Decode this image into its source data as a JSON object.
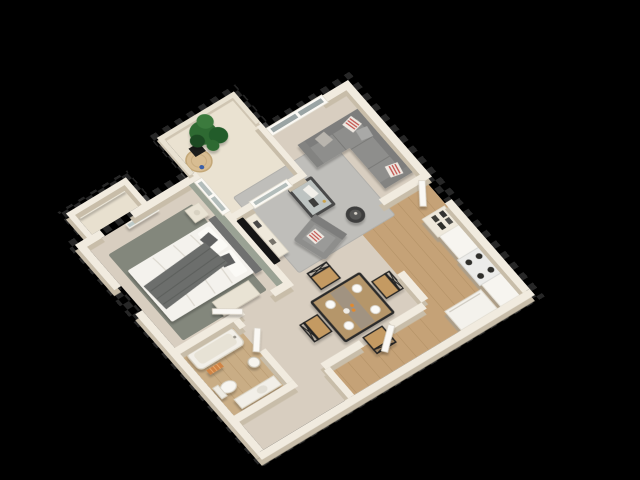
{
  "meta": {
    "description": "3D isometric dollhouse render of a one-bedroom apartment floor plan, rotated roughly 33 degrees, floating on a solid black background",
    "render_style": "photoreal architectural 3D floor plan, top-down oblique view",
    "visible_text": "none"
  },
  "palette": {
    "bg": "#000000",
    "wallTop": "#f1ebdf",
    "wallSide": "#c8bda9",
    "wallLow": "#e9e2d2",
    "carpet": "#d8cec0",
    "wood": "#c5a277",
    "bathFloor": "#c9ad85",
    "rugLiving": "#bfbeba",
    "rugBedroom": "#83877c",
    "sofa": "#8e8e8c",
    "sofaDark": "#7d7d7b",
    "accentWall": "#9aa294",
    "blanket": "#6c6e6c",
    "tableWood": "#b5966b",
    "chairWood": "#c49a62",
    "frameBlack": "#232321",
    "plantGreen": "#2e6b33",
    "towelOrange": "#d08445",
    "glass": "#bcc8c6",
    "white": "#f4f2ec"
  },
  "rooms": [
    {
      "id": "living-room",
      "name": "Living Room",
      "floor": "beige carpet",
      "furniture": [
        "gray L-shaped sectional sofa",
        "red-and-white striped throw pillows",
        "glass coffee table with books",
        "gray armchair",
        "round black side table",
        "light gray area rug",
        "wall-mounted flat TV",
        "cream media console",
        "double window"
      ]
    },
    {
      "id": "kitchen",
      "name": "Kitchen",
      "floor": "light wood planks",
      "furniture": [
        "white counter run",
        "cooktop stove with four burners",
        "white refrigerator",
        "pantry shelf with dark dishes"
      ]
    },
    {
      "id": "dining-area",
      "name": "Dining Area",
      "floor": "beige carpet",
      "furniture": [
        "square black-frame dining table with wood top",
        "four cross-back chairs with wood seats",
        "four white place-setting plates",
        "oranges centerpiece"
      ]
    },
    {
      "id": "bedroom",
      "name": "Bedroom",
      "floor": "beige carpet",
      "furniture": [
        "double bed with white duvet",
        "dark gray throw blanket",
        "white and gray pillows",
        "sage accent headboard wall",
        "cream nightstand",
        "cream dresser-desk",
        "leaning floor mirror",
        "dark gray-green area rug",
        "window to balcony"
      ]
    },
    {
      "id": "bathroom",
      "name": "Bathroom",
      "floor": "light wood planks",
      "furniture": [
        "bathtub",
        "toilet",
        "white vanity with sink",
        "pedestal basin",
        "orange folded towels",
        "white door"
      ]
    },
    {
      "id": "balcony",
      "name": "Balcony",
      "floor": "cream concrete",
      "furniture": [
        "potted green plant",
        "black planter",
        "round jute rug",
        "blue bottle",
        "low railing walls"
      ]
    },
    {
      "id": "walk-in-closet",
      "name": "Walk-in Closet",
      "floor": "cream",
      "furniture": [
        "white shelving band"
      ]
    },
    {
      "id": "entry-hall",
      "name": "Entry Hall",
      "floor": "light wood planks",
      "furniture": [
        "white front door ajar",
        "white hall door"
      ]
    }
  ],
  "doors": {
    "count": 4,
    "style": "white panel leaves shown ajar"
  },
  "windows": {
    "count": 3,
    "style": "white frames with gray glazing"
  },
  "artifacts": {
    "edge_checkerboard": "faint gray transparency checker blocks along outer walls"
  }
}
